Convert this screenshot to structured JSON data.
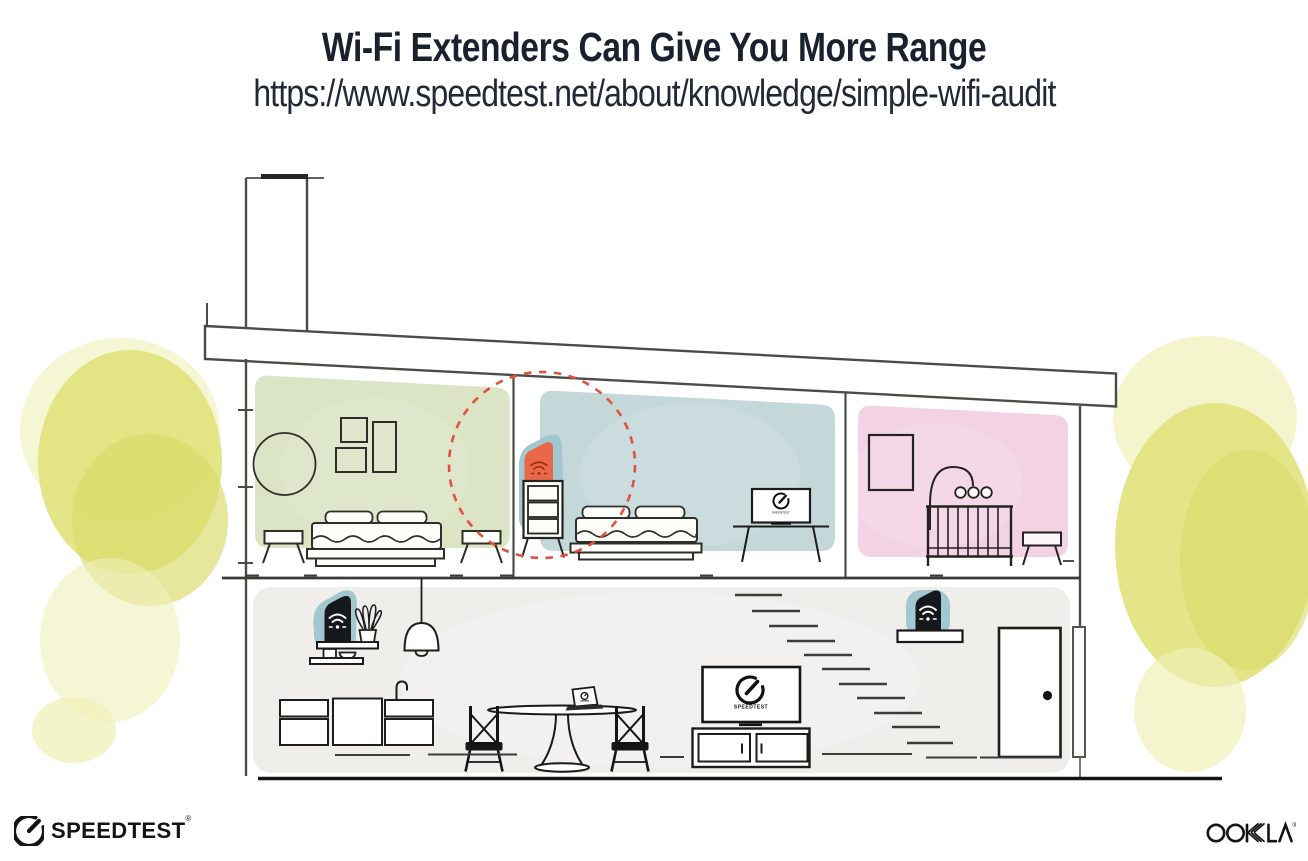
{
  "header": {
    "title": "Wi-Fi Extenders Can Give You More Range",
    "url": "https://www.speedtest.net/about/knowledge/simple-wifi-audit"
  },
  "illustration": {
    "tv_screen_label": "SPEEDTEST",
    "upstairs_tv_label": "SPEEDTEST"
  },
  "footer": {
    "speedtest_wordmark": "SPEEDTEST",
    "speedtest_registered": "®",
    "ookla_wordmark": "OOKLA",
    "ookla_registered": "®"
  },
  "colors": {
    "title_text": "#1a202e",
    "line": "#4c4c47",
    "ink": "#17181a",
    "room_green": "#dbe5c6",
    "room_blue": "#c4d8da",
    "room_pink": "#f3d2e3",
    "room_gray": "#efeeeb",
    "foliage": "#e1e27b",
    "foliage_dark": "#d9da69",
    "foliage_light": "#eff0b8",
    "extender_teal": "#a2c7ce",
    "extender_orange": "#e9684a",
    "wifi_dark_red": "#9c2f16",
    "dashed_circle": "#dd5340"
  }
}
